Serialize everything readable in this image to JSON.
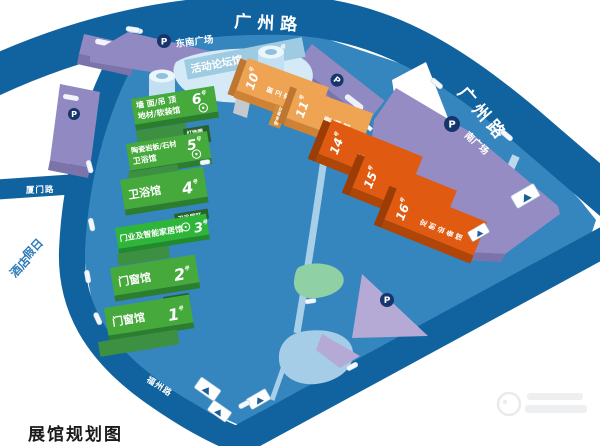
{
  "map_title": "展馆规划图",
  "roads": {
    "guangzhou_top": "广州路",
    "guangzhou_right": "广州路",
    "xiamen": "厦门路",
    "fuzhou": "福州路"
  },
  "places": {
    "hotel_line1": "假日",
    "hotel_line2": "酒店",
    "southeast_plaza": "东南广场",
    "south_plaza": "南广场",
    "parking": "P"
  },
  "forum_hall": {
    "name": "活动论坛馆",
    "num": "9",
    "suffix": "号"
  },
  "green_halls": [
    {
      "num": "6",
      "suffix": "号",
      "line1": "墙 面/吊 顶",
      "line2": "地材/软装馆"
    },
    {
      "num": "5",
      "suffix": "号",
      "line1": "陶瓷岩板/石材",
      "line2": "卫浴馆"
    },
    {
      "num": "4",
      "suffix": "号",
      "name": "卫浴馆"
    },
    {
      "num": "3",
      "suffix": "号",
      "name": "门业及智能家居馆"
    },
    {
      "num": "2",
      "suffix": "号",
      "name": "门窗馆"
    },
    {
      "num": "1",
      "suffix": "号",
      "name": "门窗馆"
    }
  ],
  "zone_tags": {
    "lighting_line1": "灯饰照",
    "lighting_line2": "明展区",
    "bath": "卫浴展区",
    "window_line1": "门窗配",
    "window_line2": "套展区",
    "appliance": "家电展区"
  },
  "orange_halls": [
    {
      "num": "10",
      "suffix": "号",
      "name": "厨卫家电馆"
    },
    {
      "num": "11",
      "suffix": "号",
      "name": "暖通馆"
    },
    {
      "num": "14",
      "suffix": "号",
      "name": "定制家居馆"
    },
    {
      "num": "15",
      "suffix": "号",
      "name": "定制家居馆"
    },
    {
      "num": "16",
      "suffix": "号",
      "name": "定制设备馆"
    }
  ],
  "colors": {
    "road": "#11639f",
    "campus": "#3586be",
    "green_hall": "#46a93b",
    "orange_light": "#efa453",
    "orange_dark": "#e05a11",
    "purple": "#9189c2"
  }
}
